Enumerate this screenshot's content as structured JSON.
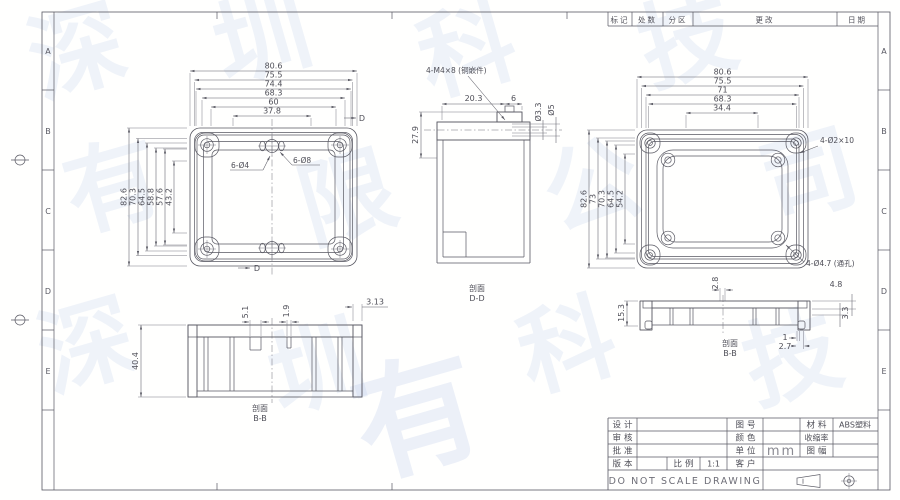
{
  "colors": {
    "line": "#585862",
    "watermark": "#96ade0",
    "mm_text": "#8a8a92"
  },
  "watermark": {
    "glyphs": [
      "深",
      "圳",
      "科",
      "技",
      "有",
      "限",
      "公",
      "司"
    ]
  },
  "zones": [
    "A",
    "B",
    "C",
    "D",
    "E"
  ],
  "revision_header": {
    "cells": [
      "标记",
      "处数",
      "分区",
      "更改",
      "日期"
    ]
  },
  "views": {
    "base_top": {
      "h_dims": [
        "80.6",
        "75.5",
        "74.4",
        "68.3",
        "60",
        "37.8"
      ],
      "v_dims": [
        "82.6",
        "70.3",
        "64.5",
        "58.8",
        "57.6",
        "43.2"
      ],
      "callout_holes_small": "6-Ø4",
      "callout_holes_large": "6-Ø8",
      "section_mark": "D"
    },
    "section_dd": {
      "label": "剖面",
      "name": "D-D",
      "callout": "4-M4×8 (铜嵌件)",
      "dim_left": "27.9",
      "dim_top": "20.3",
      "dim_top_right": "6",
      "bore_small": "Ø3.3",
      "bore_large": "Ø5"
    },
    "lid_top": {
      "h_dims": [
        "80.6",
        "75.5",
        "71",
        "68.3",
        "34.4"
      ],
      "v_dims": [
        "82.6",
        "73",
        "70.3",
        "64.5",
        "54.2"
      ],
      "callout_pins": "4-Ø2×10",
      "callout_holes": "4-Ø4.7 (通孔)"
    },
    "base_section": {
      "label": "剖面",
      "name": "B-B",
      "dim_height": "40.4",
      "dim_rib_a": "5.1",
      "dim_rib_b": "1.9",
      "dim_wall": "3.13"
    },
    "lid_section": {
      "label": "剖面",
      "name": "B-B",
      "dim_height": "15.3",
      "dim_slot": "2.8",
      "dim_flange": "4.8",
      "dim_lip": "3.3",
      "dim_foot_a": "1",
      "dim_foot_b": "2.7"
    }
  },
  "title_block": {
    "design_label": "设计",
    "check_label": "审核",
    "approve_label": "批准",
    "version_label": "版本",
    "scale_label": "比例",
    "scale_value": "1:1",
    "drawing_no_label": "图号",
    "color_label": "颜色",
    "unit_label": "单位",
    "unit_value": "mm",
    "customer_label": "客户",
    "material_label": "材料",
    "material_value": "ABS塑料",
    "shrinkage_label": "收缩率",
    "sheet_label": "图幅",
    "footer": "DO NOT SCALE DRAWING"
  }
}
